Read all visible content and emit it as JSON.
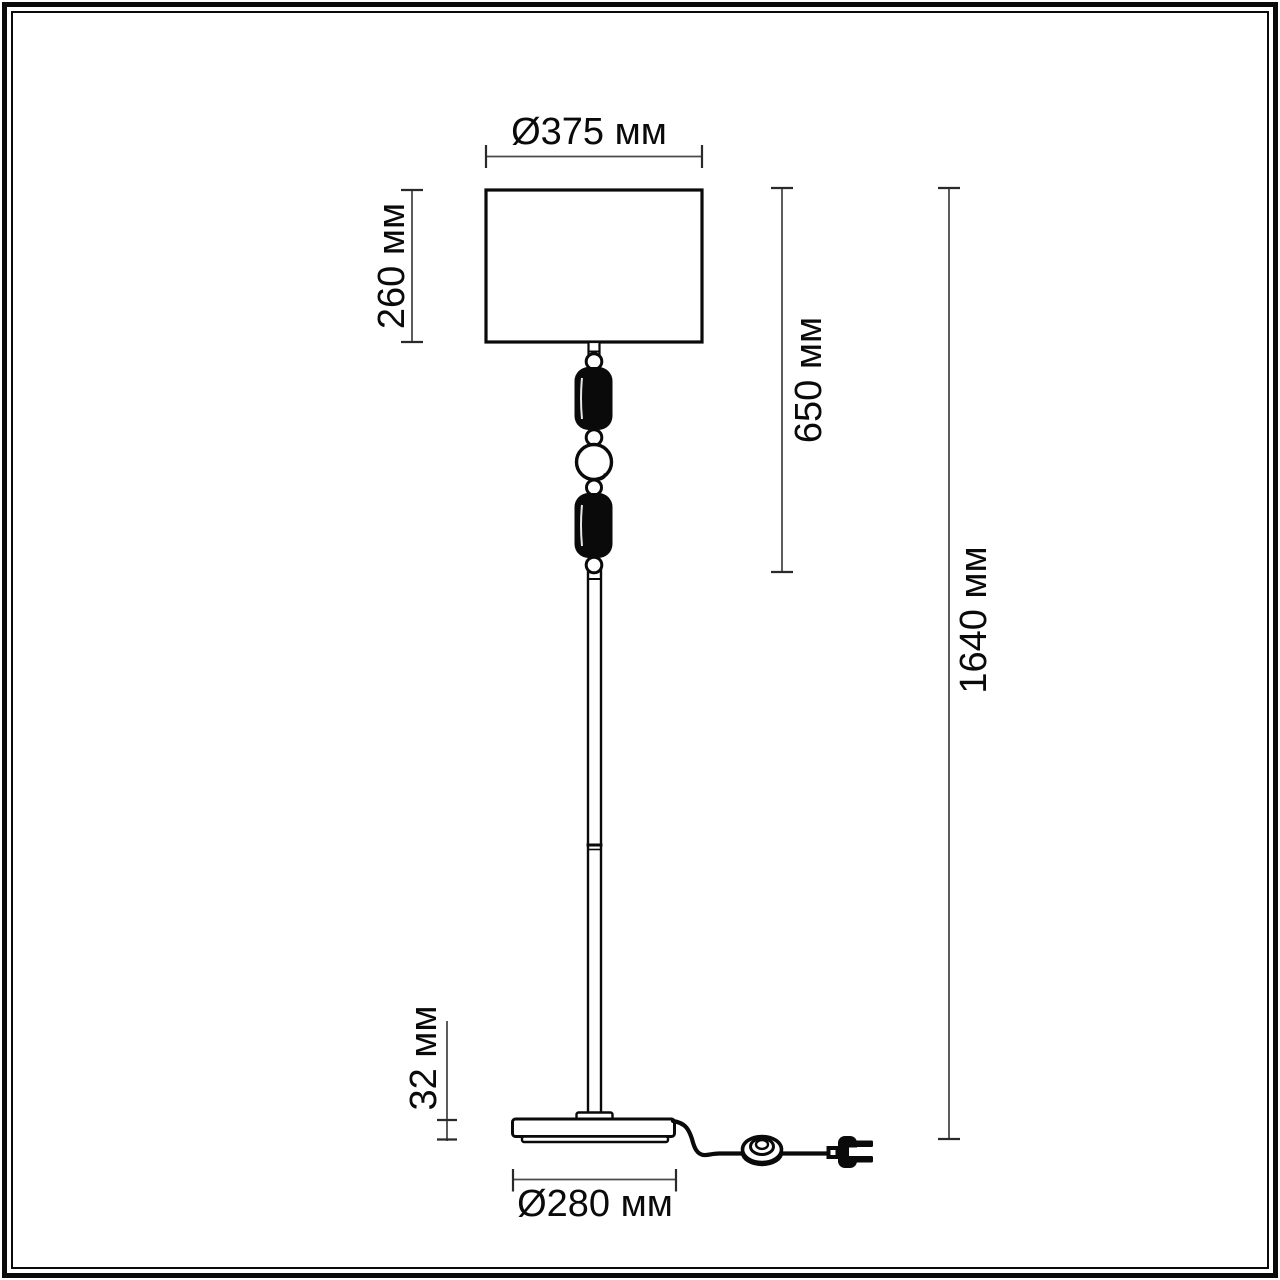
{
  "page": {
    "background": "#ffffff",
    "frame_color": "#0a0a0a"
  },
  "drawing": {
    "subject": "floor-lamp-dimension-diagram",
    "units": "мм",
    "line_color": "#0a0a0a",
    "dimension_line_color": "#4a4a4a",
    "labels": {
      "shade_diameter": "Ø375 мм",
      "shade_height": "260 мм",
      "upper_section_height": "650 мм",
      "total_height": "1640 мм",
      "base_thickness": "32 мм",
      "base_diameter": "Ø280 мм"
    },
    "values_mm": {
      "shade_diameter": 375,
      "shade_height": 260,
      "upper_section_height": 650,
      "total_height": 1640,
      "base_thickness": 32,
      "base_diameter": 280
    }
  }
}
